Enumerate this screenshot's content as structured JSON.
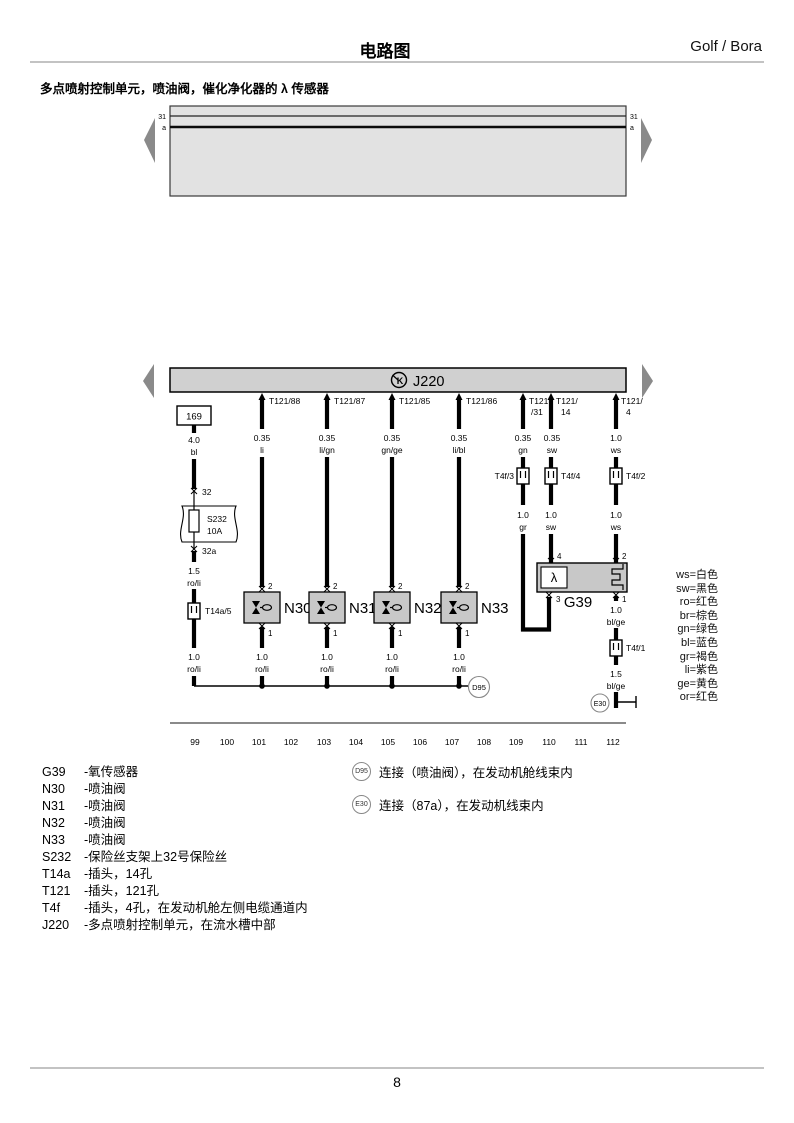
{
  "header": {
    "title": "电路图",
    "brand": "Golf / Bora",
    "subtitle": "多点喷射控制单元，喷油阀，催化净化器的 λ 传感器"
  },
  "footer": {
    "page": "8"
  },
  "bus": {
    "left_top": "31",
    "left_bottom": "a",
    "right_top": "31",
    "right_bottom": "a"
  },
  "ecu": {
    "label": "J220",
    "diag_symbol": "K"
  },
  "supply": {
    "track_ref": "169",
    "gauge1": "4.0",
    "color1": "bl",
    "junction_top": "32",
    "fuse_code": "S232",
    "fuse_rating": "10A",
    "junction_bottom": "32a",
    "gauge2": "1.5",
    "color2": "ro/li",
    "connector": "T14a/5",
    "gauge3": "1.0",
    "color3": "ro/li"
  },
  "injectors": [
    {
      "terminal": "T121/88",
      "gauge": "0.35",
      "color": "li",
      "pin_top": "2",
      "pin_bottom": "1",
      "label": "N30",
      "gauge_bottom": "1.0",
      "color_bottom": "ro/li"
    },
    {
      "terminal": "T121/87",
      "gauge": "0.35",
      "color": "li/gn",
      "pin_top": "2",
      "pin_bottom": "1",
      "label": "N31",
      "gauge_bottom": "1.0",
      "color_bottom": "ro/li"
    },
    {
      "terminal": "T121/85",
      "gauge": "0.35",
      "color": "gn/ge",
      "pin_top": "2",
      "pin_bottom": "1",
      "label": "N32",
      "gauge_bottom": "1.0",
      "color_bottom": "ro/li"
    },
    {
      "terminal": "T121/86",
      "gauge": "0.35",
      "color": "li/bl",
      "pin_top": "2",
      "pin_bottom": "1",
      "label": "N33",
      "gauge_bottom": "1.0",
      "color_bottom": "ro/li"
    }
  ],
  "sensor_wires": [
    {
      "terminal_l1": "T121",
      "terminal_l2": "/31",
      "gauge": "0.35",
      "color": "gn",
      "connector": "T4f/3",
      "gauge2": "1.0",
      "color2": "gr",
      "pin": "3"
    },
    {
      "terminal_l1": "T121/",
      "terminal_l2": "14",
      "gauge": "0.35",
      "color": "sw",
      "connector": "T4f/4",
      "gauge2": "1.0",
      "color2": "sw",
      "pin": "4"
    },
    {
      "terminal_l1": "T121/",
      "terminal_l2": "4",
      "gauge": "1.0",
      "color": "ws",
      "connector": "T4f/2",
      "gauge2": "1.0",
      "color2": "ws",
      "pin": "2"
    }
  ],
  "sensor": {
    "label": "G39",
    "symbol": "λ",
    "pin_out": "1",
    "out_gauge1": "1.0",
    "out_color1": "bl/ge",
    "connector": "T4f/1",
    "out_gauge2": "1.5",
    "out_color2": "bl/ge"
  },
  "junctions": {
    "d95": "D95",
    "e30": "E30"
  },
  "tracks": [
    "99",
    "100",
    "101",
    "102",
    "103",
    "104",
    "105",
    "106",
    "107",
    "108",
    "109",
    "110",
    "111",
    "112"
  ],
  "color_legend": [
    "ws=白色",
    "sw=黑色",
    "ro=红色",
    "br=棕色",
    "gn=绿色",
    "bl=蓝色",
    "gr=褐色",
    "li=紫色",
    "ge=黄色",
    "or=红色"
  ],
  "component_legend": [
    {
      "code": "G39",
      "desc": "-氧传感器"
    },
    {
      "code": "N30",
      "desc": "-喷油阀"
    },
    {
      "code": "N31",
      "desc": "-喷油阀"
    },
    {
      "code": "N32",
      "desc": "-喷油阀"
    },
    {
      "code": "N33",
      "desc": "-喷油阀"
    },
    {
      "code": "S232",
      "desc": "-保险丝支架上32号保险丝"
    },
    {
      "code": "T14a",
      "desc": "-插头，14孔"
    },
    {
      "code": "T121",
      "desc": "-插头，121孔"
    },
    {
      "code": "T4f",
      "desc": "-插头，4孔，在发动机舱左侧电缆通道内"
    },
    {
      "code": "J220",
      "desc": "-多点喷射控制单元，在流水槽中部"
    }
  ],
  "connection_legend": [
    {
      "ref": "D95",
      "desc": "连接（喷油阀），在发动机舱线束内"
    },
    {
      "ref": "E30",
      "desc": "连接（87a），在发动机线束内"
    }
  ]
}
